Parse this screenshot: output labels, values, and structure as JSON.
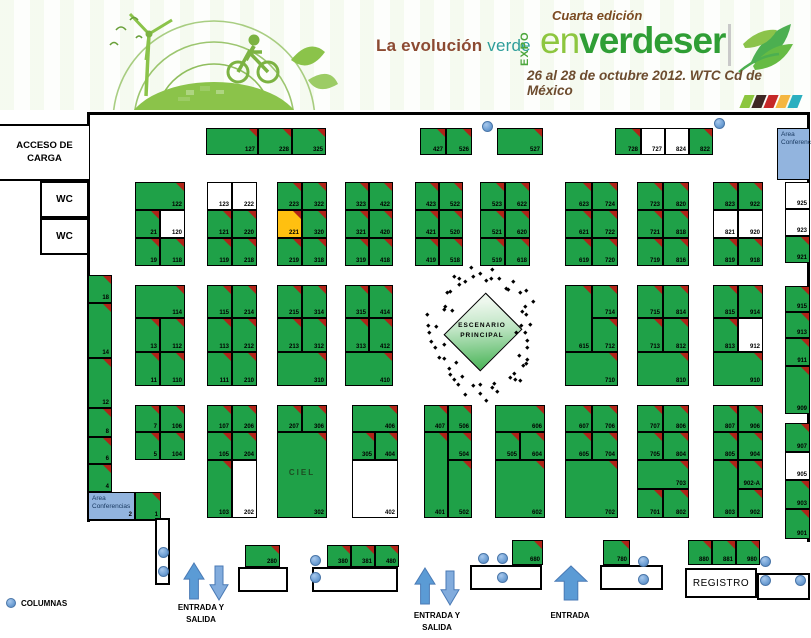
{
  "header": {
    "tagline_left": "La evolución",
    "tagline_right": "verde",
    "expo_vertical": "EXPO",
    "edition": "Cuarta edición",
    "brand_en": "en",
    "brand_rest": "verdeser",
    "date_line": "26 al 28 de octubre 2012. WTC Cd de México",
    "strip_colors": [
      "#8cc63f",
      "#3e2723",
      "#c62828",
      "#f4b63f",
      "#2bafbf"
    ]
  },
  "labels": {
    "acceso_carga": "ACCESO DE CARGA",
    "wc": "WC",
    "area_conferencias": "Area Conferencias",
    "escenario_line1": "ESCENARIO",
    "escenario_line2": "PRINCIPAL",
    "ciel": "CIEL",
    "registro": "REGISTRO",
    "entrada_salida_line1": "ENTRADA Y",
    "entrada_salida_line2": "SALIDA",
    "entrada": "ENTRADA",
    "columnas": "COLUMNAS"
  },
  "colors": {
    "booth_occupied": "#1fa148",
    "booth_available": "#ffffff",
    "booth_highlight": "#ffc010",
    "corner_flag": "#b02418",
    "conference_area": "#92b4de",
    "column_dot": "#6e9fd4",
    "arrow_blue": "#5b9bd5"
  },
  "booths": [
    [
      "127",
      206,
      128,
      52,
      27,
      "g"
    ],
    [
      "228",
      258,
      128,
      34,
      27,
      "g"
    ],
    [
      "325",
      292,
      128,
      34,
      27,
      "g"
    ],
    [
      "427",
      420,
      128,
      26,
      27,
      "g"
    ],
    [
      "526",
      446,
      128,
      26,
      27,
      "g"
    ],
    [
      "527",
      497,
      128,
      46,
      27,
      "g"
    ],
    [
      "728",
      615,
      128,
      26,
      27,
      "g"
    ],
    [
      "727",
      641,
      128,
      24,
      27,
      "w"
    ],
    [
      "824",
      665,
      128,
      24,
      27,
      "w"
    ],
    [
      "822",
      689,
      128,
      24,
      27,
      "g"
    ],
    [
      "122",
      135,
      182,
      50,
      28,
      "g"
    ],
    [
      "21",
      135,
      210,
      25,
      28,
      "g"
    ],
    [
      "120",
      160,
      210,
      25,
      28,
      "w"
    ],
    [
      "19",
      135,
      238,
      25,
      28,
      "g"
    ],
    [
      "118",
      160,
      238,
      25,
      28,
      "g"
    ],
    [
      "123",
      207,
      182,
      25,
      28,
      "w"
    ],
    [
      "222",
      232,
      182,
      25,
      28,
      "w"
    ],
    [
      "121",
      207,
      210,
      25,
      28,
      "g"
    ],
    [
      "220",
      232,
      210,
      25,
      28,
      "g"
    ],
    [
      "119",
      207,
      238,
      25,
      28,
      "g"
    ],
    [
      "218",
      232,
      238,
      25,
      28,
      "g"
    ],
    [
      "223",
      277,
      182,
      25,
      28,
      "g"
    ],
    [
      "322",
      302,
      182,
      25,
      28,
      "g"
    ],
    [
      "221",
      277,
      210,
      25,
      28,
      "o"
    ],
    [
      "320",
      302,
      210,
      25,
      28,
      "g"
    ],
    [
      "219",
      277,
      238,
      25,
      28,
      "g"
    ],
    [
      "318",
      302,
      238,
      25,
      28,
      "g"
    ],
    [
      "323",
      345,
      182,
      24,
      28,
      "g"
    ],
    [
      "422",
      369,
      182,
      24,
      28,
      "g"
    ],
    [
      "321",
      345,
      210,
      24,
      28,
      "g"
    ],
    [
      "420",
      369,
      210,
      24,
      28,
      "g"
    ],
    [
      "319",
      345,
      238,
      24,
      28,
      "g"
    ],
    [
      "418",
      369,
      238,
      24,
      28,
      "g"
    ],
    [
      "423",
      415,
      182,
      24,
      28,
      "g"
    ],
    [
      "522",
      439,
      182,
      24,
      28,
      "g"
    ],
    [
      "421",
      415,
      210,
      24,
      28,
      "g"
    ],
    [
      "520",
      439,
      210,
      24,
      28,
      "g"
    ],
    [
      "419",
      415,
      238,
      24,
      28,
      "g"
    ],
    [
      "518",
      439,
      238,
      24,
      28,
      "g"
    ],
    [
      "523",
      480,
      182,
      25,
      28,
      "g"
    ],
    [
      "622",
      505,
      182,
      25,
      28,
      "g"
    ],
    [
      "521",
      480,
      210,
      25,
      28,
      "g"
    ],
    [
      "620",
      505,
      210,
      25,
      28,
      "g"
    ],
    [
      "519",
      480,
      238,
      25,
      28,
      "g"
    ],
    [
      "618",
      505,
      238,
      25,
      28,
      "g"
    ],
    [
      "623",
      565,
      182,
      27,
      28,
      "g"
    ],
    [
      "724",
      592,
      182,
      26,
      28,
      "g"
    ],
    [
      "621",
      565,
      210,
      27,
      28,
      "g"
    ],
    [
      "722",
      592,
      210,
      26,
      28,
      "g"
    ],
    [
      "619",
      565,
      238,
      27,
      28,
      "g"
    ],
    [
      "720",
      592,
      238,
      26,
      28,
      "g"
    ],
    [
      "723",
      637,
      182,
      26,
      28,
      "g"
    ],
    [
      "820",
      663,
      182,
      26,
      28,
      "g"
    ],
    [
      "721",
      637,
      210,
      26,
      28,
      "g"
    ],
    [
      "818",
      663,
      210,
      26,
      28,
      "g"
    ],
    [
      "719",
      637,
      238,
      26,
      28,
      "g"
    ],
    [
      "816",
      663,
      238,
      26,
      28,
      "g"
    ],
    [
      "823",
      713,
      182,
      25,
      28,
      "g"
    ],
    [
      "922",
      738,
      182,
      25,
      28,
      "g"
    ],
    [
      "821",
      713,
      210,
      25,
      28,
      "w"
    ],
    [
      "920",
      738,
      210,
      25,
      28,
      "w"
    ],
    [
      "819",
      713,
      238,
      25,
      28,
      "g"
    ],
    [
      "918",
      738,
      238,
      25,
      28,
      "g"
    ],
    [
      "925",
      785,
      182,
      25,
      27,
      "w"
    ],
    [
      "923",
      785,
      209,
      25,
      27,
      "w"
    ],
    [
      "921",
      785,
      236,
      25,
      27,
      "g"
    ],
    [
      "915",
      785,
      286,
      25,
      26,
      "g"
    ],
    [
      "913",
      785,
      312,
      25,
      26,
      "g"
    ],
    [
      "911",
      785,
      338,
      25,
      28,
      "g"
    ],
    [
      "909",
      785,
      366,
      25,
      48,
      "g"
    ],
    [
      "907",
      785,
      423,
      25,
      29,
      "g"
    ],
    [
      "905",
      785,
      452,
      25,
      28,
      "w"
    ],
    [
      "903",
      785,
      480,
      25,
      29,
      "g"
    ],
    [
      "901",
      785,
      509,
      25,
      30,
      "g"
    ],
    [
      "18",
      88,
      275,
      24,
      28,
      "g"
    ],
    [
      "14",
      88,
      303,
      24,
      55,
      "g"
    ],
    [
      "12",
      88,
      358,
      24,
      50,
      "g"
    ],
    [
      "8",
      88,
      408,
      24,
      29,
      "g"
    ],
    [
      "6",
      88,
      437,
      24,
      27,
      "g"
    ],
    [
      "4",
      88,
      464,
      24,
      28,
      "g"
    ],
    [
      "1",
      135,
      492,
      26,
      28,
      "g"
    ],
    [
      "114",
      135,
      285,
      50,
      33,
      "g"
    ],
    [
      "13",
      135,
      318,
      25,
      34,
      "g"
    ],
    [
      "112",
      160,
      318,
      25,
      34,
      "g"
    ],
    [
      "11",
      135,
      352,
      25,
      34,
      "g"
    ],
    [
      "110",
      160,
      352,
      25,
      34,
      "g"
    ],
    [
      "115",
      207,
      285,
      25,
      33,
      "g"
    ],
    [
      "214",
      232,
      285,
      25,
      33,
      "g"
    ],
    [
      "113",
      207,
      318,
      25,
      34,
      "g"
    ],
    [
      "212",
      232,
      318,
      25,
      34,
      "g"
    ],
    [
      "111",
      207,
      352,
      25,
      34,
      "g"
    ],
    [
      "210",
      232,
      352,
      25,
      34,
      "g"
    ],
    [
      "215",
      277,
      285,
      25,
      33,
      "g"
    ],
    [
      "314",
      302,
      285,
      25,
      33,
      "g"
    ],
    [
      "213",
      277,
      318,
      25,
      34,
      "g"
    ],
    [
      "312",
      302,
      318,
      25,
      34,
      "g"
    ],
    [
      "310",
      277,
      352,
      50,
      34,
      "g"
    ],
    [
      "315",
      345,
      285,
      24,
      33,
      "g"
    ],
    [
      "414",
      369,
      285,
      24,
      33,
      "g"
    ],
    [
      "313",
      345,
      318,
      24,
      34,
      "g"
    ],
    [
      "412",
      369,
      318,
      24,
      34,
      "g"
    ],
    [
      "410",
      345,
      352,
      48,
      34,
      "g"
    ],
    [
      "615",
      565,
      285,
      27,
      67,
      "g"
    ],
    [
      "714",
      592,
      285,
      26,
      33,
      "g"
    ],
    [
      "712",
      592,
      318,
      26,
      34,
      "g"
    ],
    [
      "710",
      565,
      352,
      53,
      34,
      "g"
    ],
    [
      "715",
      637,
      285,
      26,
      33,
      "g"
    ],
    [
      "814",
      663,
      285,
      26,
      33,
      "g"
    ],
    [
      "713",
      637,
      318,
      26,
      34,
      "g"
    ],
    [
      "812",
      663,
      318,
      26,
      34,
      "g"
    ],
    [
      "810",
      637,
      352,
      52,
      34,
      "g"
    ],
    [
      "815",
      713,
      285,
      25,
      33,
      "g"
    ],
    [
      "914",
      738,
      285,
      25,
      33,
      "g"
    ],
    [
      "813",
      713,
      318,
      25,
      34,
      "g"
    ],
    [
      "912",
      738,
      318,
      25,
      34,
      "w"
    ],
    [
      "910",
      713,
      352,
      50,
      34,
      "g"
    ],
    [
      "7",
      135,
      405,
      25,
      27,
      "g"
    ],
    [
      "106",
      160,
      405,
      25,
      27,
      "g"
    ],
    [
      "5",
      135,
      432,
      25,
      28,
      "g"
    ],
    [
      "104",
      160,
      432,
      25,
      28,
      "g"
    ],
    [
      "107",
      207,
      405,
      25,
      27,
      "g"
    ],
    [
      "206",
      232,
      405,
      25,
      27,
      "g"
    ],
    [
      "105",
      207,
      432,
      25,
      28,
      "g"
    ],
    [
      "204",
      232,
      432,
      25,
      28,
      "g"
    ],
    [
      "103",
      207,
      460,
      25,
      58,
      "g"
    ],
    [
      "202",
      232,
      460,
      25,
      58,
      "w"
    ],
    [
      "207",
      277,
      405,
      25,
      27,
      "g"
    ],
    [
      "306",
      302,
      405,
      25,
      27,
      "g"
    ],
    [
      "302",
      277,
      432,
      50,
      86,
      "g"
    ],
    [
      "406",
      352,
      405,
      46,
      27,
      "g"
    ],
    [
      "305",
      352,
      432,
      23,
      28,
      "g"
    ],
    [
      "404",
      375,
      432,
      23,
      28,
      "g"
    ],
    [
      "402",
      352,
      460,
      46,
      58,
      "w"
    ],
    [
      "407",
      424,
      405,
      24,
      27,
      "g"
    ],
    [
      "506",
      448,
      405,
      24,
      27,
      "g"
    ],
    [
      "401",
      424,
      432,
      24,
      86,
      "g"
    ],
    [
      "504",
      448,
      432,
      24,
      28,
      "g"
    ],
    [
      "502",
      448,
      460,
      24,
      58,
      "g"
    ],
    [
      "606",
      495,
      405,
      50,
      27,
      "g"
    ],
    [
      "505",
      495,
      432,
      25,
      28,
      "g"
    ],
    [
      "604",
      520,
      432,
      25,
      28,
      "g"
    ],
    [
      "602",
      495,
      460,
      50,
      58,
      "g"
    ],
    [
      "607",
      565,
      405,
      27,
      27,
      "g"
    ],
    [
      "706",
      592,
      405,
      26,
      27,
      "g"
    ],
    [
      "605",
      565,
      432,
      27,
      28,
      "g"
    ],
    [
      "704",
      592,
      432,
      26,
      28,
      "g"
    ],
    [
      "702",
      565,
      460,
      53,
      58,
      "g"
    ],
    [
      "707",
      637,
      405,
      26,
      27,
      "g"
    ],
    [
      "806",
      663,
      405,
      26,
      27,
      "g"
    ],
    [
      "705",
      637,
      432,
      26,
      28,
      "g"
    ],
    [
      "804",
      663,
      432,
      26,
      28,
      "g"
    ],
    [
      "703",
      637,
      460,
      52,
      29,
      "g"
    ],
    [
      "701",
      637,
      489,
      26,
      29,
      "g"
    ],
    [
      "802",
      663,
      489,
      26,
      29,
      "g"
    ],
    [
      "807",
      713,
      405,
      25,
      27,
      "g"
    ],
    [
      "906",
      738,
      405,
      25,
      27,
      "g"
    ],
    [
      "805",
      713,
      432,
      25,
      28,
      "g"
    ],
    [
      "904",
      738,
      432,
      25,
      28,
      "g"
    ],
    [
      "803",
      713,
      460,
      25,
      58,
      "g"
    ],
    [
      "902-A",
      738,
      460,
      25,
      29,
      "g"
    ],
    [
      "902",
      738,
      489,
      25,
      29,
      "g"
    ],
    [
      "280",
      245,
      545,
      35,
      22,
      "g"
    ],
    [
      "380",
      327,
      545,
      24,
      22,
      "g"
    ],
    [
      "381",
      351,
      545,
      24,
      22,
      "g"
    ],
    [
      "480",
      375,
      545,
      24,
      22,
      "g"
    ],
    [
      "680",
      512,
      540,
      31,
      25,
      "g"
    ],
    [
      "780",
      603,
      540,
      27,
      25,
      "g"
    ],
    [
      "880",
      688,
      540,
      24,
      25,
      "g"
    ],
    [
      "881",
      712,
      540,
      24,
      25,
      "g"
    ],
    [
      "980",
      736,
      540,
      24,
      25,
      "g"
    ]
  ],
  "ciel_booth": "302",
  "conference_areas": [
    {
      "x": 777,
      "y": 128,
      "w": 33,
      "h": 52,
      "corner_num": ""
    },
    {
      "x": 88,
      "y": 492,
      "w": 47,
      "h": 28,
      "corner_num": "2"
    }
  ],
  "counters": [
    [
      238,
      567,
      50,
      25
    ],
    [
      312,
      567,
      86,
      25
    ],
    [
      470,
      565,
      72,
      25
    ],
    [
      600,
      565,
      63,
      25
    ],
    [
      757,
      573,
      53,
      27
    ],
    [
      155,
      518,
      15,
      67
    ]
  ],
  "registro_box": [
    685,
    568,
    72,
    30
  ],
  "columns": [
    [
      487,
      126
    ],
    [
      719,
      123
    ],
    [
      163,
      552
    ],
    [
      163,
      571
    ],
    [
      315,
      560
    ],
    [
      315,
      577
    ],
    [
      483,
      558
    ],
    [
      502,
      558
    ],
    [
      502,
      577
    ],
    [
      643,
      561
    ],
    [
      643,
      579
    ],
    [
      765,
      561
    ],
    [
      765,
      580
    ],
    [
      800,
      580
    ]
  ],
  "arrows": [
    {
      "dir": "up",
      "x": 183,
      "y": 562,
      "w": 22,
      "h": 38,
      "shade": "dark"
    },
    {
      "dir": "down",
      "x": 209,
      "y": 565,
      "w": 20,
      "h": 36,
      "shade": "light"
    },
    {
      "dir": "up",
      "x": 414,
      "y": 567,
      "w": 22,
      "h": 38,
      "shade": "dark"
    },
    {
      "dir": "down",
      "x": 440,
      "y": 570,
      "w": 20,
      "h": 36,
      "shade": "light"
    },
    {
      "dir": "up",
      "x": 554,
      "y": 565,
      "w": 34,
      "h": 36,
      "shade": "dark"
    }
  ],
  "entrance_labels": [
    {
      "cx": 201,
      "y": 602,
      "lines": [
        "ENTRADA Y",
        "SALIDA"
      ]
    },
    {
      "cx": 437,
      "y": 610,
      "lines": [
        "ENTRADA Y",
        "SALIDA"
      ]
    },
    {
      "cx": 570,
      "y": 610,
      "lines": [
        "ENTRADA"
      ]
    }
  ],
  "escenario": {
    "cx": 482,
    "cy": 331
  }
}
